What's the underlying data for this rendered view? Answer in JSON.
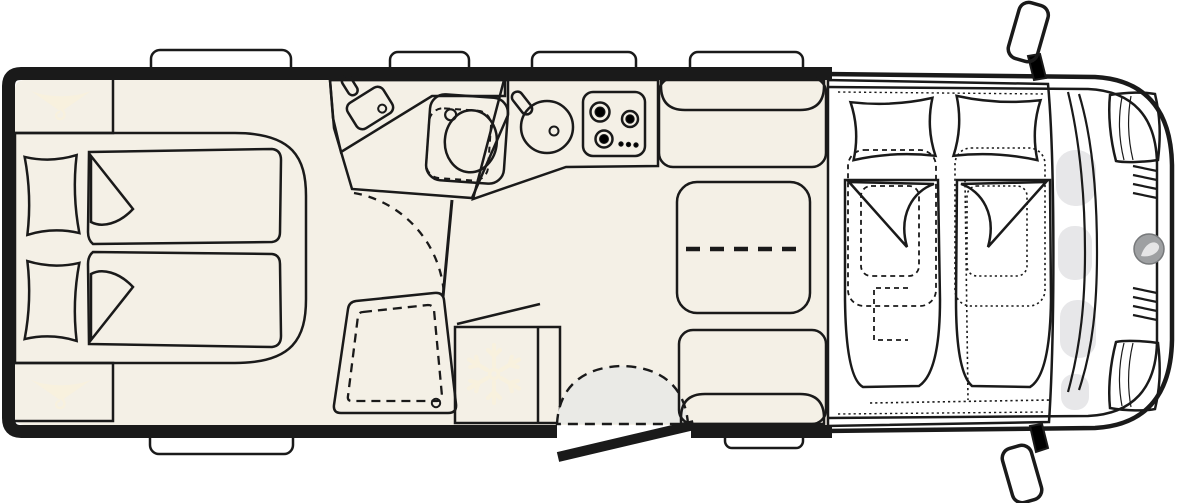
{
  "title": "motorhome-floor-plan",
  "colors": {
    "line": "#1a1a1a",
    "wall": "#1a1a1a",
    "floor": "#f4f0e6",
    "furniture": "#ece5d6",
    "cabinet": "#ebba7e",
    "fabric": "#c7c8c5",
    "backrest": "#c2c3c0",
    "vanity": "#d8d8da",
    "wetroom": "#dae4f2",
    "fixture": "#ededef",
    "doorarc": "#eaeae6",
    "cab": "#ffffff",
    "hood": "#e7e7e9",
    "logo": "#9ea0a2",
    "icon": "#f8f1de",
    "window": "#ffffff"
  },
  "icons": {
    "wardrobe_rear_top": "clothes-hanger-icon",
    "wardrobe_rear_bottom": "clothes-hanger-icon",
    "fridge": "snowflake-icon",
    "bathroom_sink": "faucet-icon",
    "kitchen_sink": "faucet-icon"
  },
  "fixtures": {
    "rear_bedroom": [
      "wardrobe",
      "single-bed",
      "single-bed",
      "wardrobe"
    ],
    "bathroom": [
      "vanity-counter",
      "washbasin",
      "toilet",
      "door-swing"
    ],
    "shower": [
      "shower-tray",
      "drain"
    ],
    "kitchen": [
      "counter",
      "round-sink",
      "gas-hob-3-burner",
      "fridge"
    ],
    "dinette": [
      "bench",
      "table-extendable",
      "bench"
    ],
    "entry": [
      "door-swing",
      "open-door-leaf",
      "entry-step"
    ],
    "cab": [
      "drop-down-bed",
      "swivel-seat",
      "swivel-seat",
      "mirror",
      "mirror"
    ]
  }
}
